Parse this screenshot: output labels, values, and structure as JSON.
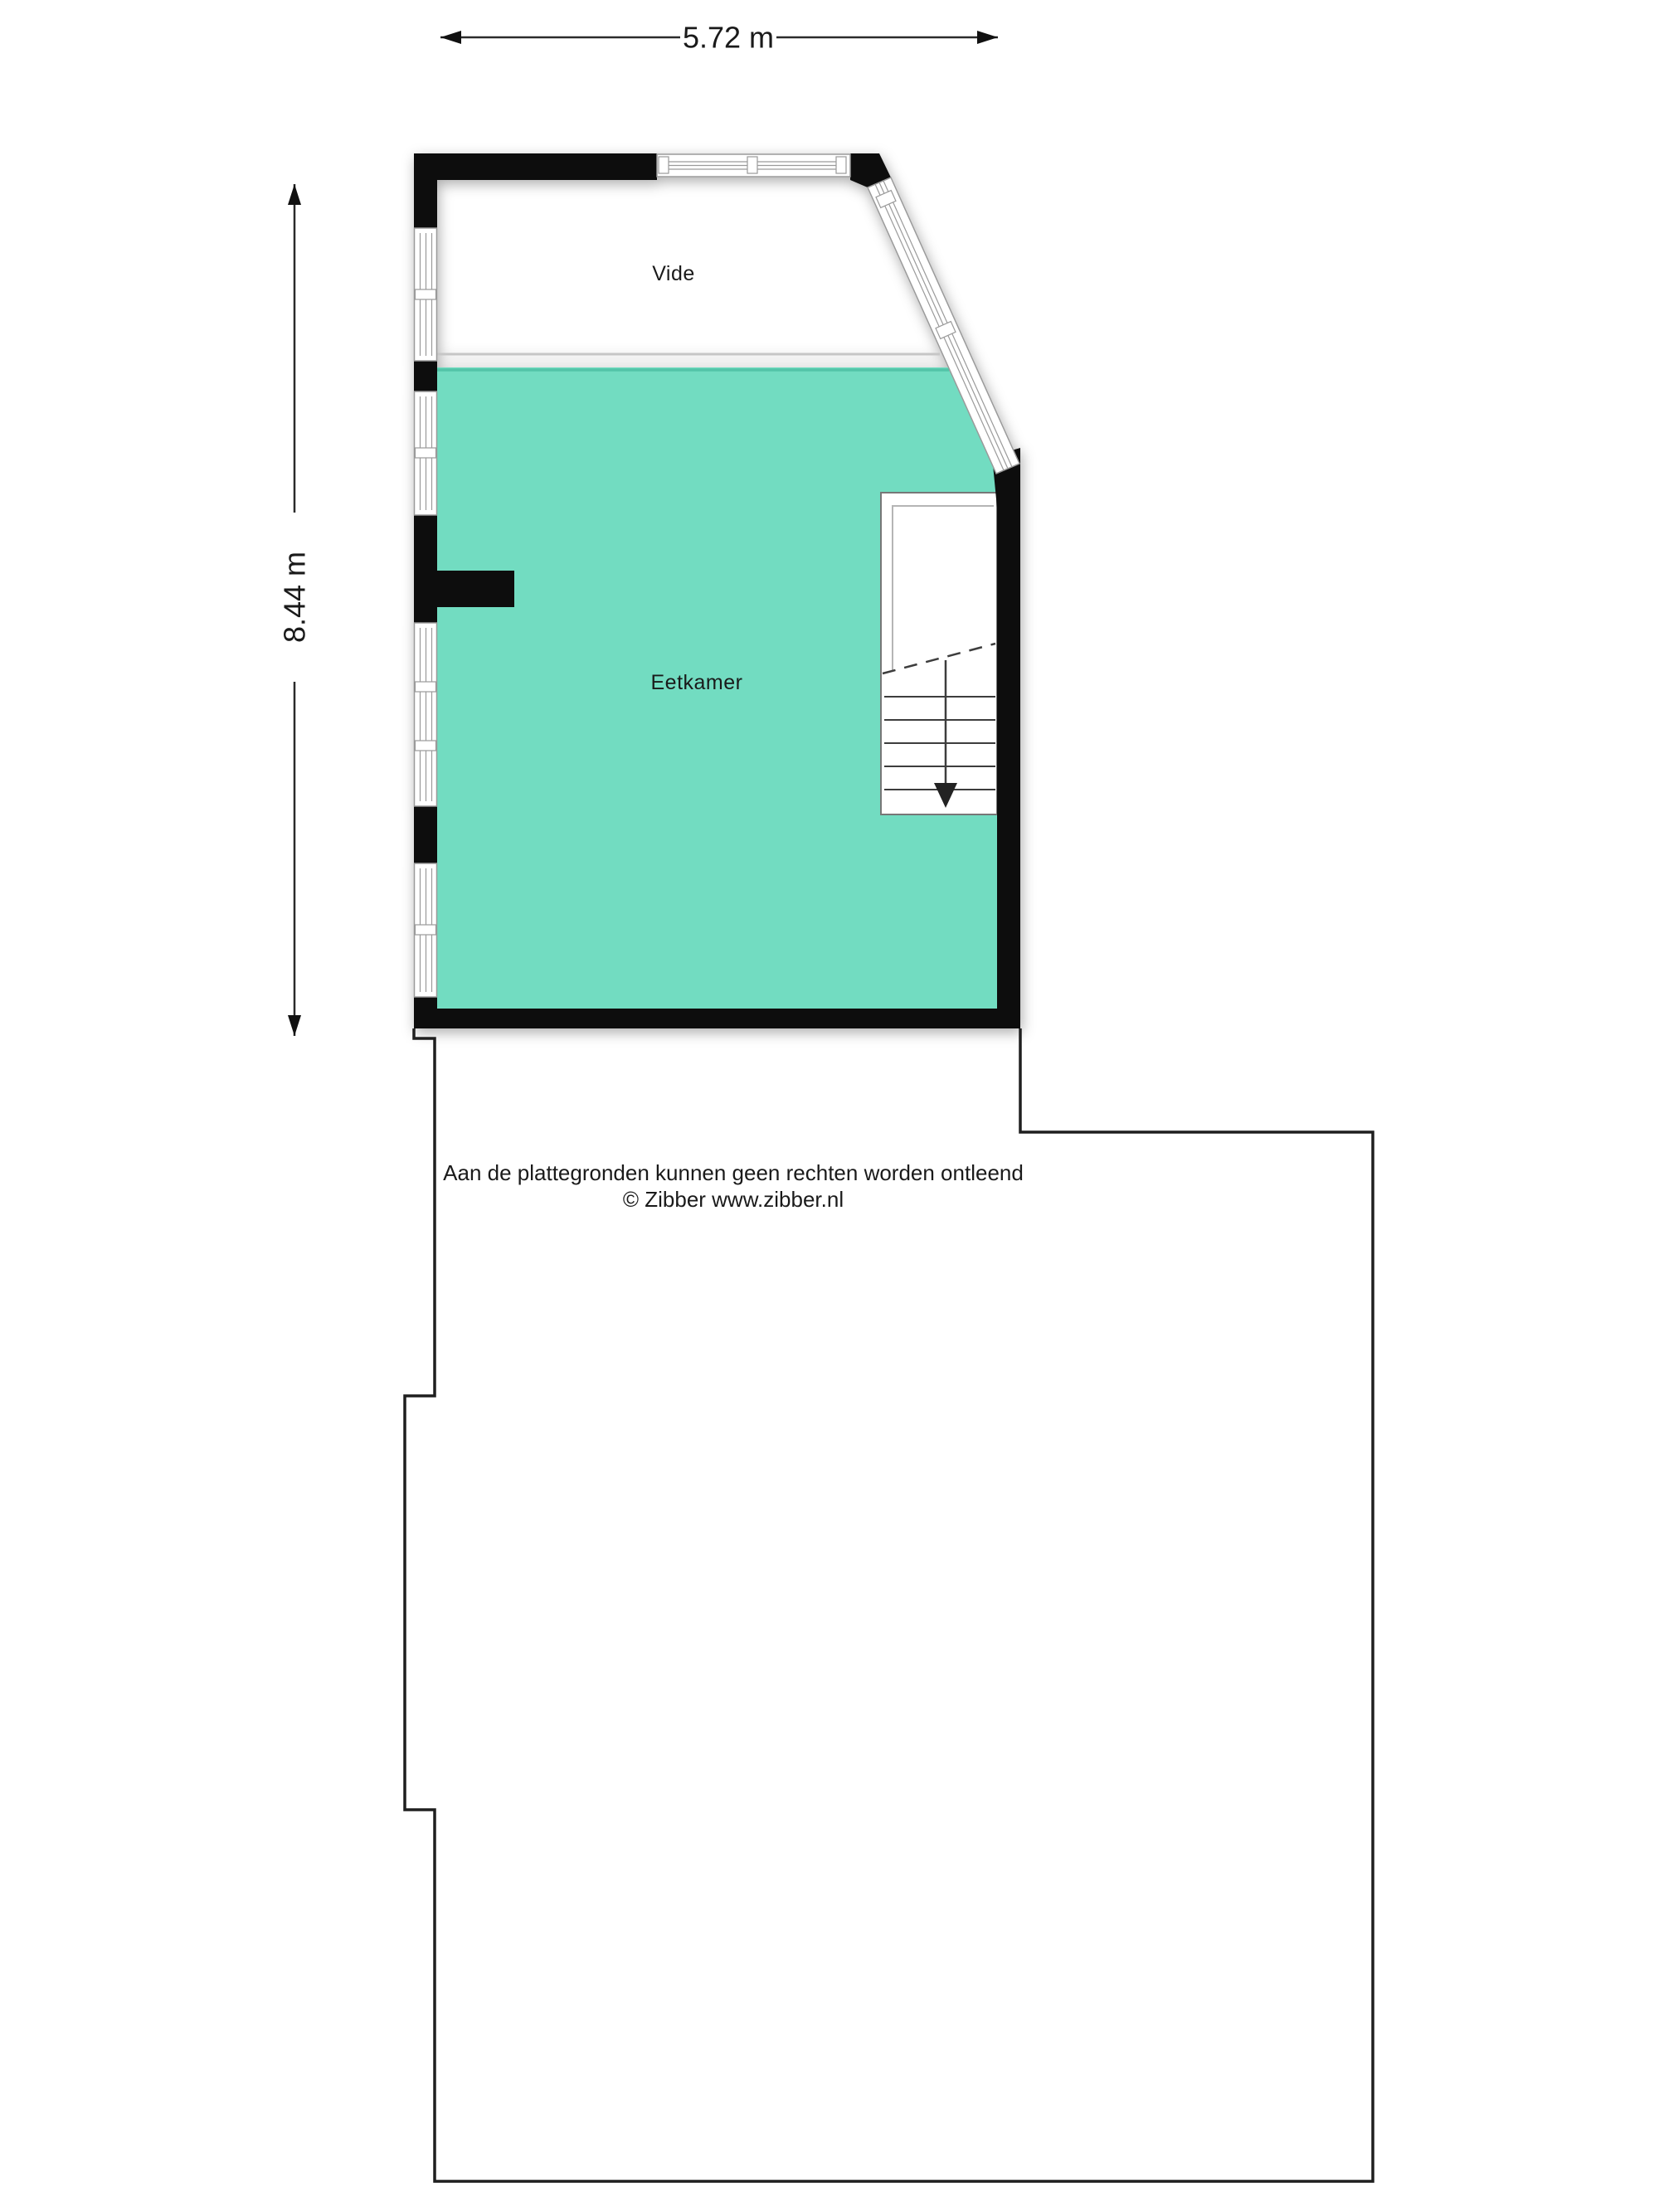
{
  "dimensions": {
    "width": "5.72 m",
    "height": "8.44 m"
  },
  "rooms": {
    "vide": "Vide",
    "eetkamer": "Eetkamer"
  },
  "disclaimer": {
    "line1": "Aan de plattegronden kunnen geen rechten worden ontleend",
    "line2": "© Zibber www.zibber.nl"
  },
  "colors": {
    "room_fill": "#72dcc1",
    "room_edge": "#52c3a8",
    "wall": "#0b0b0b",
    "outline": "#1f1f1f",
    "window_frame": "#9a9a9a",
    "dimension_line": "#2b2b2b",
    "stair_line": "#3c3c3c"
  }
}
